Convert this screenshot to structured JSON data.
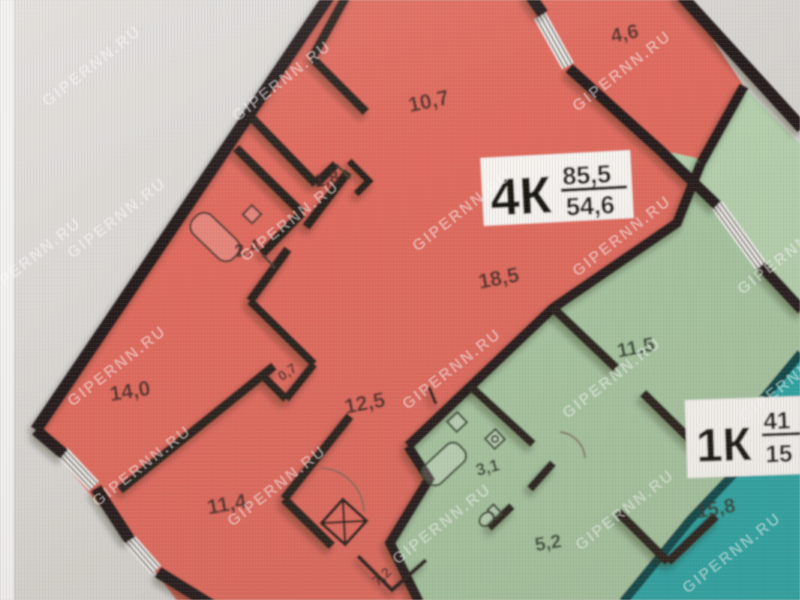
{
  "photo": {
    "watermark_text": "GIPERNN.RU"
  },
  "apartment_4k": {
    "label": "4К",
    "area_total": "85,5",
    "area_living": "54,6",
    "rooms": {
      "balcony": "4,6",
      "bedroom_top": "10,7",
      "closet": "1,8",
      "bathroom": "2,4",
      "living_room": "18,5",
      "storage": "0,7",
      "hallway": "12,5",
      "bedroom_left": "14,0",
      "bedroom_bottom": "11,4",
      "room_partial": "7,2"
    }
  },
  "apartment_1k": {
    "label": "1К",
    "area_total": "41",
    "area_living": "15",
    "rooms": {
      "living_room": "11,5",
      "bathroom": "3,1",
      "hallway": "5,2",
      "kitchen": "15,8"
    }
  },
  "colors": {
    "apartment_4k_fill": "#e2695c",
    "apartment_4k_loggia": "#e87465",
    "apartment_1k_fill": "#a5c49e",
    "apartment_1k_loggia": "#b3cfab",
    "neighbor_fill": "#2aa6a4",
    "walls": "#261f1a",
    "background_light": "#e0ddd9",
    "background_dark": "#cfccc8",
    "label_box": "#f6f3ef"
  }
}
